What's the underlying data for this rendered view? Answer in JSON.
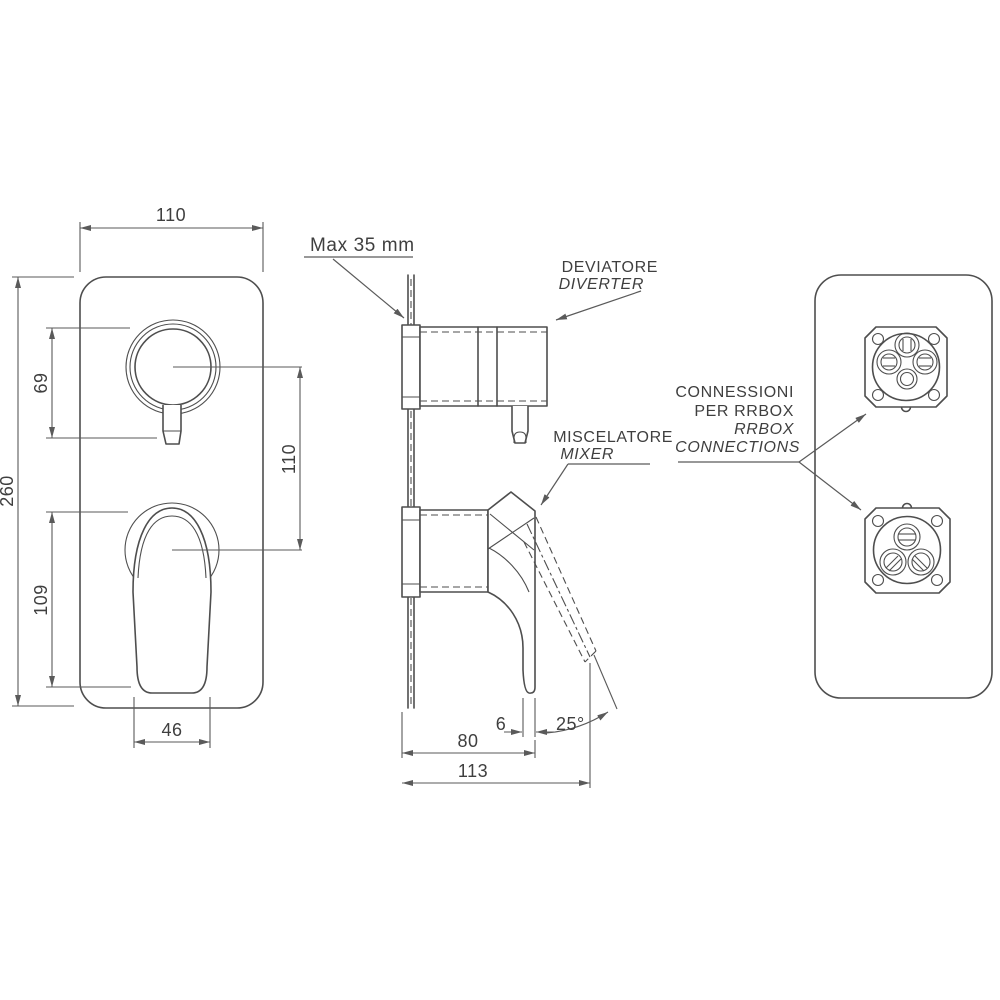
{
  "views": {
    "front": {
      "dims": {
        "plate_width": "110",
        "plate_height": "260",
        "diverter_height": "69",
        "handle_height": "109",
        "handle_width": "46",
        "center_distance": "110"
      }
    },
    "side": {
      "max_depth_label": "Max 35 mm",
      "diverter_label_it": "DEVIATORE",
      "diverter_label_en": "DIVERTER",
      "mixer_label_it": "MISCELATORE",
      "mixer_label_en": "MIXER",
      "dims": {
        "lever_thickness": "6",
        "body_depth": "80",
        "total_depth": "113",
        "lever_angle": "25°"
      }
    },
    "back": {
      "connections_line1": "CONNESSIONI",
      "connections_line2": "PER RRBOX",
      "connections_line3": "RRBOX",
      "connections_line4": "CONNECTIONS"
    }
  },
  "colors": {
    "line": "#4e4e4e",
    "dimension": "#5a5a5a",
    "text": "#3f3f3f",
    "background": "#ffffff"
  }
}
